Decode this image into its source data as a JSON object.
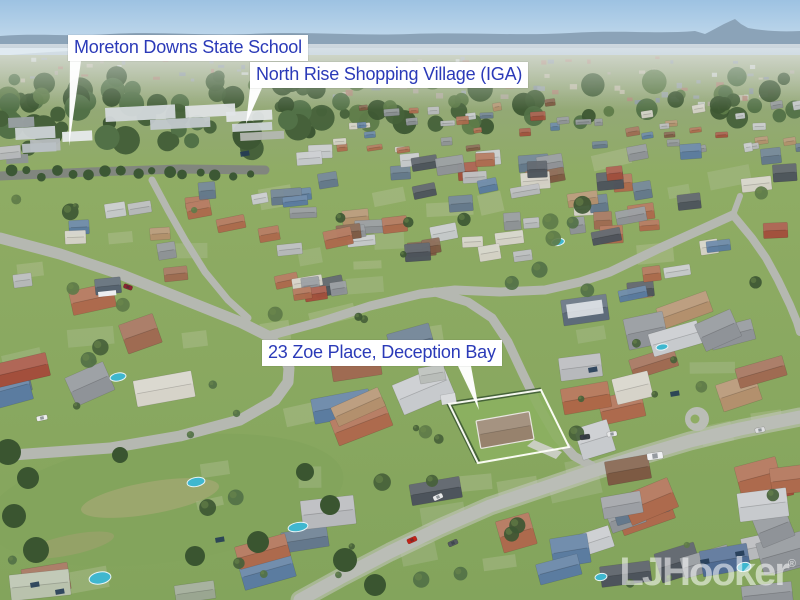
{
  "scene": {
    "description": "Aerial drone photograph of a coastal residential suburb with hazy mountain horizon, winding streets, green lawns and a highlighted property boundary",
    "colors": {
      "sky_top": "#9dc2e2",
      "sky_horizon": "#d3e4f0",
      "mountains": "#8ba3b8",
      "far_ridge": "#a6bbcc",
      "haze": "#c6cfc6",
      "forest": "#46603a",
      "grass": "#8fac64",
      "field": "#83a45c",
      "road": "#b5b8b1",
      "avenue": "#81867e",
      "pool": "#3fb7cf",
      "subject_roof": "#97826d",
      "label_text": "#2b3ab8",
      "label_bg": "#ffffff",
      "pointer": "#ffffff",
      "boundary": "#fffffa",
      "watermark": "rgba(255,255,255,0.55)"
    }
  },
  "annotations": {
    "school": {
      "label": "Moreton Downs State School"
    },
    "shopping": {
      "label": "North Rise Shopping Village (IGA)"
    },
    "property": {
      "label": "23 Zoe Place, Deception Bay"
    }
  },
  "watermark": {
    "brand": "LJHooker",
    "mark": "®"
  }
}
